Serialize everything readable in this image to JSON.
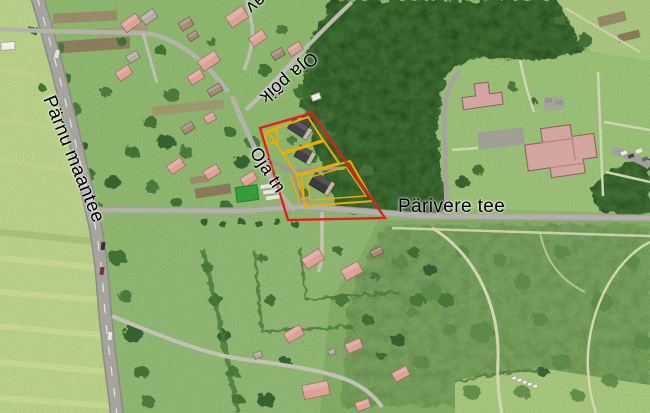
{
  "map": {
    "road_labels": {
      "parnu_maantee": "Pärnu maantee",
      "oja_poik": "Oja põik",
      "oja_tn": "Oja tn",
      "parivere_tee": "Pärivere tee",
      "top_edge_partial": "av"
    },
    "overlay_colors": {
      "selection_outline": "#e61f1f",
      "parcel_outline": "#f2b100"
    }
  }
}
